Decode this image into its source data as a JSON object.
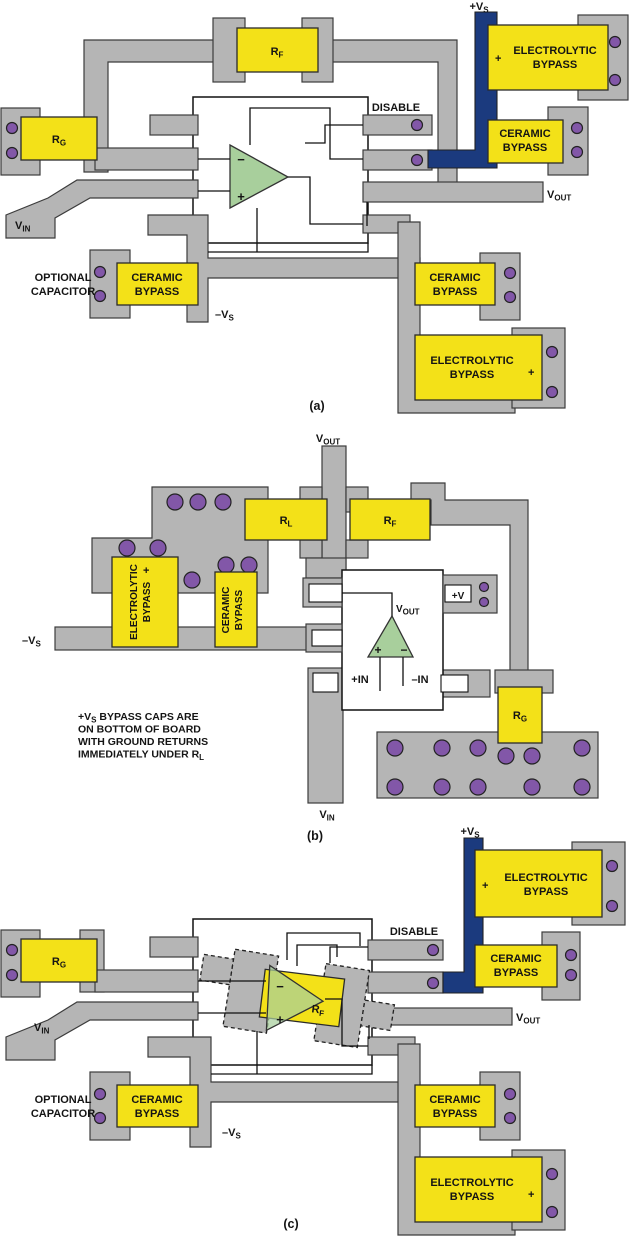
{
  "colors": {
    "copper_trace": "#b5b5b5",
    "component_yellow": "#f3e118",
    "via_purple": "#8257a8",
    "opamp_green": "#a8cf9c",
    "supply_navy": "#1b3a7e",
    "outline": "#2b2b2b",
    "background": "#ffffff"
  },
  "labels": {
    "disable": "DISABLE",
    "optional_capacitor": [
      "OPTIONAL",
      "CAPACITOR"
    ],
    "ceramic_bypass": [
      "CERAMIC",
      "BYPASS"
    ],
    "electrolytic_bypass": [
      "ELECTROLYTIC",
      "BYPASS"
    ],
    "plus": "+",
    "minus": "−",
    "rf": {
      "m": "R",
      "s": "F"
    },
    "rg": {
      "m": "R",
      "s": "G"
    },
    "rl": {
      "m": "R",
      "s": "L"
    },
    "vin": {
      "m": "V",
      "s": "IN"
    },
    "vout": {
      "m": "V",
      "s": "OUT"
    },
    "vs_plus": {
      "m": "+V",
      "s": "S"
    },
    "vs_minus": {
      "m": "–V",
      "s": "S"
    },
    "in_plus": "+IN",
    "in_minus": "–IN",
    "v_plus": "+V"
  },
  "note": {
    "l1_pre": "+V",
    "l1_sub": "S",
    "l1_post": " BYPASS CAPS ARE",
    "l2": "ON BOTTOM OF BOARD",
    "l3": "WITH GROUND RETURNS",
    "l4_pre": "IMMEDIATELY UNDER R",
    "l4_sub": "L"
  },
  "captions": {
    "a": "(a)",
    "b": "(b)",
    "c": "(c)"
  }
}
